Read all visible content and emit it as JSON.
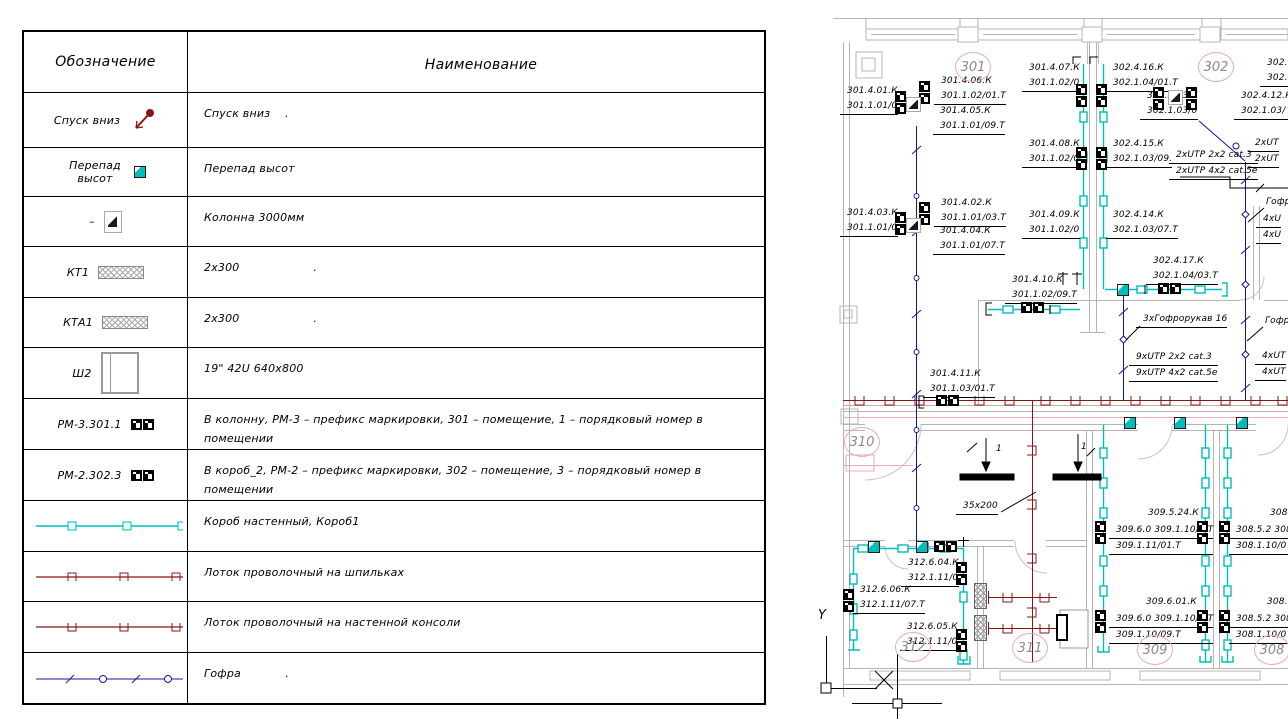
{
  "legend": {
    "col1_header": "Обозначение",
    "col2_header": "Наименование",
    "rows": [
      {
        "symbol_label": "Спуск вниз",
        "name": "Спуск вниз    ."
      },
      {
        "symbol_label": "Перепад высот",
        "name": "Перепад высот"
      },
      {
        "symbol_label": "–",
        "name": "Колонна 3000мм"
      },
      {
        "symbol_label": "КТ1",
        "name": "2х300                    ."
      },
      {
        "symbol_label": "КТА1",
        "name": "2х300                    ."
      },
      {
        "symbol_label": "Ш2",
        "name": "19\" 42U 640х800"
      },
      {
        "symbol_label": "РМ-3.301.1",
        "name": "В колонну, РМ-3 – префикс маркировки, 301 – помещение, 1 – порядковый номер в помещении"
      },
      {
        "symbol_label": "РМ-2.302.3",
        "name": "В короб_2, РМ-2 – префикс маркировки, 302 – помещение, 3 – порядковый номер в помещении"
      },
      {
        "symbol_label": "",
        "name": "Короб настенный, Короб1"
      },
      {
        "symbol_label": "",
        "name": "Лоток проволочный на шпильках"
      },
      {
        "symbol_label": "",
        "name": "Лоток проволочный на настенной консоли"
      },
      {
        "symbol_label": "",
        "name": "Гофра            ."
      }
    ]
  },
  "plan": {
    "rooms": [
      {
        "x": 973,
        "y": 67,
        "label": "301"
      },
      {
        "x": 1216,
        "y": 67,
        "label": "302"
      },
      {
        "x": 862,
        "y": 442,
        "label": "310"
      },
      {
        "x": 913,
        "y": 647,
        "label": "312"
      },
      {
        "x": 1030,
        "y": 648,
        "label": "311"
      },
      {
        "x": 1155,
        "y": 650,
        "label": "309"
      },
      {
        "x": 1272,
        "y": 650,
        "label": "308"
      }
    ],
    "labels": [
      {
        "x": 847,
        "y": 84,
        "lines": [
          "301.4.01.К",
          "301.1.01/0"
        ],
        "u": true
      },
      {
        "x": 941,
        "y": 74,
        "lines": [
          "301.4.06.К",
          "301.1.02/01.Т"
        ],
        "u": true
      },
      {
        "x": 940,
        "y": 104,
        "lines": [
          "301.4.05.К",
          "301.1.01/09.Т"
        ],
        "u": true
      },
      {
        "x": 1029,
        "y": 61,
        "lines": [
          "301.4.07.К",
          "301.1.02/0"
        ],
        "u": true
      },
      {
        "x": 1113,
        "y": 61,
        "lines": [
          "302.4.16.К",
          "302.1.04/01.Т"
        ],
        "u": true
      },
      {
        "x": 1147,
        "y": 89,
        "lines": [
          "302.4.13.К",
          "302.1.03/0"
        ],
        "u": true
      },
      {
        "x": 1241,
        "y": 89,
        "lines": [
          "302.4.12.К",
          "302.1.03/"
        ],
        "u": true
      },
      {
        "x": 1267,
        "y": 56,
        "lines": [
          "302.",
          "302."
        ],
        "u": true
      },
      {
        "x": 1029,
        "y": 137,
        "lines": [
          "301.4.08.К",
          "301.1.02/0"
        ],
        "u": true
      },
      {
        "x": 1113,
        "y": 137,
        "lines": [
          "302.4.15.К",
          "302.1.03/09."
        ],
        "u": true
      },
      {
        "x": 1176,
        "y": 148,
        "lines": [
          "2хUTP 2х2 cat.3",
          "2хUTP 4х2 cat.5е"
        ],
        "u2": true
      },
      {
        "x": 1255,
        "y": 136,
        "lines": [
          "2хUT",
          "2хUT"
        ],
        "u2": true
      },
      {
        "x": 847,
        "y": 206,
        "lines": [
          "301.4.03.К",
          "301.1.01/0"
        ],
        "u": true
      },
      {
        "x": 941,
        "y": 196,
        "lines": [
          "301.4.02.К",
          "301.1.01/03.Т"
        ],
        "u": true
      },
      {
        "x": 940,
        "y": 224,
        "lines": [
          "301.4.04.К",
          "301.1.01/07.Т"
        ],
        "u": true
      },
      {
        "x": 1029,
        "y": 208,
        "lines": [
          "301.4.09.К",
          "301.1.02/0"
        ],
        "u": true
      },
      {
        "x": 1113,
        "y": 208,
        "lines": [
          "302.4.14.К",
          "302.1.03/07.Т"
        ],
        "u": true
      },
      {
        "x": 1153,
        "y": 254,
        "lines": [
          "302.4.17.К",
          "302.1.04/03.Т"
        ],
        "u": true
      },
      {
        "x": 1012,
        "y": 273,
        "lines": [
          "301.4.10.К",
          "301.1.02/09.Т"
        ],
        "u": true
      },
      {
        "x": 1266,
        "y": 195,
        "lines": [
          "Гофр"
        ]
      },
      {
        "x": 1263,
        "y": 212,
        "lines": [
          "4хU",
          "4хU"
        ],
        "u2": true
      },
      {
        "x": 930,
        "y": 367,
        "lines": [
          "301.4.11.К",
          "301.1.03/01.Т"
        ],
        "u": true
      },
      {
        "x": 1143,
        "y": 312,
        "lines": [
          "3хГофрорукав 16"
        ],
        "u": true
      },
      {
        "x": 1136,
        "y": 350,
        "lines": [
          "9хUTP 2х2 cat.3",
          "9хUTP 4х2 cat.5е"
        ],
        "u2": true
      },
      {
        "x": 1265,
        "y": 314,
        "lines": [
          "Гофр"
        ]
      },
      {
        "x": 1262,
        "y": 349,
        "lines": [
          "4хUТ",
          "4хUТ"
        ],
        "u2": true
      },
      {
        "x": 963,
        "y": 499,
        "lines": [
          "35х200"
        ],
        "u": true
      },
      {
        "x": 908,
        "y": 556,
        "lines": [
          "312.6.04.К",
          "312.1.11/0"
        ],
        "u": true
      },
      {
        "x": 860,
        "y": 583,
        "lines": [
          "312.6.06.К",
          "312.1.11/07.Т"
        ],
        "u": true
      },
      {
        "x": 907,
        "y": 620,
        "lines": [
          "312.6.05.К",
          "312.1.11/0"
        ],
        "u": true
      },
      {
        "x": 1148,
        "y": 506,
        "lines": [
          "309.5.24.К"
        ]
      },
      {
        "x": 1116,
        "y": 523,
        "lines": [
          "309.6.0 309.1.10/0 Т",
          "309.1.11/01.Т"
        ],
        "u2": true
      },
      {
        "x": 1270,
        "y": 506,
        "lines": [
          "308"
        ]
      },
      {
        "x": 1236,
        "y": 523,
        "lines": [
          "308.5.2 308",
          "308.1.10/0"
        ],
        "u2": true
      },
      {
        "x": 1146,
        "y": 595,
        "lines": [
          "309.6.01.К"
        ]
      },
      {
        "x": 1116,
        "y": 612,
        "lines": [
          "309.6.0 309.1.10/0 Т",
          "309.1.10/09.Т"
        ],
        "u2": true
      },
      {
        "x": 1267,
        "y": 595,
        "lines": [
          "308."
        ]
      },
      {
        "x": 1236,
        "y": 612,
        "lines": [
          "308.5.2 308",
          "308.1.10/0"
        ],
        "u2": true
      },
      {
        "x": 996,
        "y": 442,
        "lines": [
          "1"
        ]
      },
      {
        "x": 1081,
        "y": 440,
        "lines": [
          "1"
        ]
      },
      {
        "x": 818,
        "y": 608,
        "lines": [
          "Y"
        ],
        "big": true
      }
    ],
    "symbols": [
      {
        "t": "sv",
        "x": 895,
        "y": 91
      },
      {
        "t": "sv",
        "x": 919,
        "y": 81
      },
      {
        "t": "col",
        "x": 906,
        "y": 97
      },
      {
        "t": "sv",
        "x": 895,
        "y": 212
      },
      {
        "t": "sv",
        "x": 919,
        "y": 202
      },
      {
        "t": "col",
        "x": 906,
        "y": 218
      },
      {
        "t": "sv",
        "x": 1076,
        "y": 84
      },
      {
        "t": "sv",
        "x": 1096,
        "y": 84
      },
      {
        "t": "sv",
        "x": 1076,
        "y": 147
      },
      {
        "t": "sv",
        "x": 1096,
        "y": 147
      },
      {
        "t": "sv",
        "x": 1153,
        "y": 87
      },
      {
        "t": "col",
        "x": 1168,
        "y": 90
      },
      {
        "t": "sv",
        "x": 1186,
        "y": 87
      },
      {
        "t": "sh",
        "x": 1158,
        "y": 283
      },
      {
        "t": "lvl",
        "x": 1117,
        "y": 284
      },
      {
        "t": "sh",
        "x": 1021,
        "y": 302
      },
      {
        "t": "sh",
        "x": 936,
        "y": 395
      },
      {
        "t": "sh",
        "x": 934,
        "y": 541
      },
      {
        "t": "lvl",
        "x": 868,
        "y": 541
      },
      {
        "t": "lvl",
        "x": 916,
        "y": 541
      },
      {
        "t": "sv",
        "x": 956,
        "y": 562
      },
      {
        "t": "sv",
        "x": 843,
        "y": 589
      },
      {
        "t": "sv",
        "x": 956,
        "y": 629
      },
      {
        "t": "lvl",
        "x": 1124,
        "y": 417
      },
      {
        "t": "lvl",
        "x": 1174,
        "y": 417
      },
      {
        "t": "lvl",
        "x": 1236,
        "y": 417
      },
      {
        "t": "sv",
        "x": 1095,
        "y": 521
      },
      {
        "t": "sv",
        "x": 1197,
        "y": 521
      },
      {
        "t": "sv",
        "x": 1219,
        "y": 521
      },
      {
        "t": "sv",
        "x": 1095,
        "y": 610
      },
      {
        "t": "sv",
        "x": 1197,
        "y": 610
      },
      {
        "t": "sv",
        "x": 1219,
        "y": 610
      },
      {
        "t": "kt",
        "x": 974,
        "y": 583
      },
      {
        "t": "kt",
        "x": 974,
        "y": 615
      },
      {
        "t": "box",
        "x": 1056,
        "y": 614
      }
    ]
  },
  "icons": {
    "descent-arrow-icon": "maroon arrow with dot",
    "level-change-icon": "cyan square with white corner",
    "column-symbol-icon": "gray square, half-filled diagonal",
    "cable-tray-icon": "hatched rectangle",
    "cabinet-icon": "rack rectangle",
    "socket-pair-icon": "black RJ45 pair",
    "wall-duct-line-icon": "cyan line with clips",
    "wire-tray-studs-line-icon": "maroon line with clips",
    "wire-tray-console-line-icon": "maroon line with clips",
    "conduit-line-icon": "blue line with circles"
  },
  "colors": {
    "wall": "#b4b4b4",
    "duct_cyan": "#00bdbd",
    "tray_maroon": "#8c1414",
    "conduit_blue": "#1414a0",
    "cloud_pink": "#eaa8c8",
    "room_text": "#8a8a8a"
  }
}
